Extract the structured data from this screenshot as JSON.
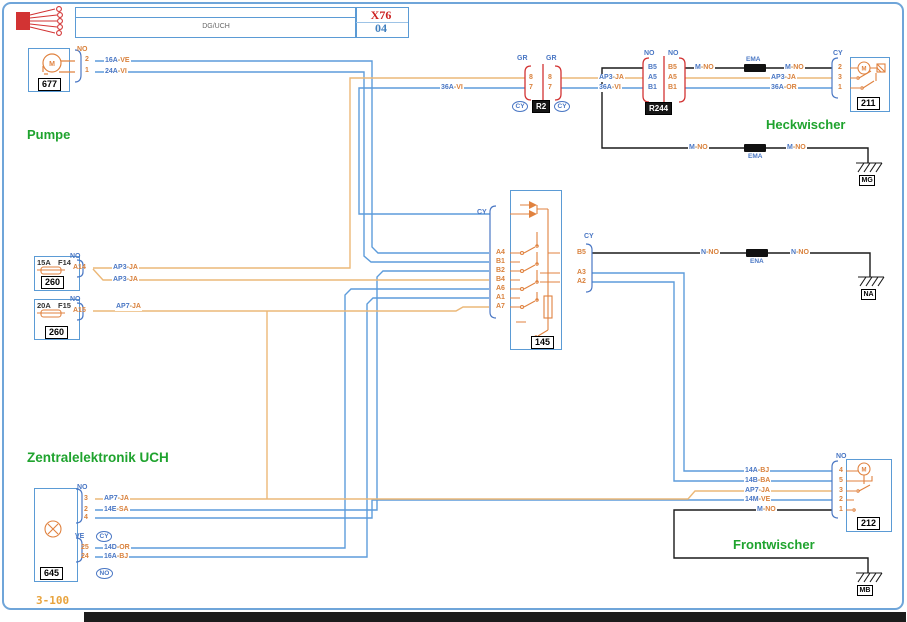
{
  "header": {
    "unit": "DG/UCH",
    "model": "X76",
    "page": "04"
  },
  "captions": {
    "pump": "Pumpe",
    "rear_wiper": "Heckwischer",
    "uch": "Zentralelektronik UCH",
    "front_wiper": "Frontwischer",
    "page_ref": "3-100"
  },
  "components": {
    "pump": {
      "number": "677",
      "connector": "NO",
      "pins": [
        "2",
        "1"
      ]
    },
    "r2": {
      "label": "R2",
      "connector_left": "GR",
      "connector_right": "GR",
      "pins": [
        "8",
        "7"
      ],
      "face": "CY"
    },
    "r244": {
      "label": "R244",
      "connector_left": "NO",
      "connector_right": "NO",
      "pins": [
        "B5",
        "A5",
        "B1"
      ]
    },
    "rear_wiper": {
      "number": "211",
      "connector": "CY",
      "pins": [
        "2",
        "3",
        "1"
      ]
    },
    "relay": {
      "number": "145",
      "connector_left": "CY",
      "connector_right": "CY",
      "pins_left": [
        "A4",
        "B1",
        "B2",
        "B4",
        "A6",
        "A1",
        "A7"
      ],
      "pins_right": [
        "B5",
        "A3",
        "A2"
      ]
    },
    "fuse_f14": {
      "rating": "15A",
      "name": "F14",
      "number": "260",
      "connector": "NO",
      "pin": "A14"
    },
    "fuse_f15": {
      "rating": "20A",
      "name": "F15",
      "number": "260",
      "connector": "NO",
      "pin": "A15"
    },
    "uch": {
      "number": "645",
      "connector_top": "NO",
      "pins_top": [
        "3",
        "2",
        "4"
      ],
      "connector_bottom": "VE",
      "pins_bottom": [
        "25",
        "24"
      ],
      "face_top": "CY",
      "face_bottom": "NO"
    },
    "front_wiper": {
      "number": "212",
      "connector": "NO",
      "pins": [
        "4",
        "5",
        "3",
        "2",
        "1"
      ]
    }
  },
  "grounds": {
    "mg": "MG",
    "na": "NA",
    "mb": "MB"
  },
  "splices": {
    "ema": "EMA",
    "ena": "ENA"
  },
  "icons": {
    "motor_letter": "M"
  },
  "wire_labels": {
    "w16ave": {
      "id": "16A",
      "color": "VE"
    },
    "w24avi": {
      "id": "24A",
      "color": "VI"
    },
    "w36avi": {
      "id": "36A",
      "color": "VI"
    },
    "w36aor": {
      "id": "36A",
      "color": "OR"
    },
    "ap3": {
      "id": "AP3",
      "color": "JA"
    },
    "ap7": {
      "id": "AP7",
      "color": "JA"
    },
    "mno": {
      "id": "M",
      "color": "NO"
    },
    "nno": {
      "id": "N",
      "color": "NO"
    },
    "w14abj": {
      "id": "14A",
      "color": "BJ"
    },
    "w14bba": {
      "id": "14B",
      "color": "BA"
    },
    "w14esa": {
      "id": "14E",
      "color": "SA"
    },
    "w14mve": {
      "id": "14M",
      "color": "VE"
    },
    "w14dor": {
      "id": "14D",
      "color": "OR"
    },
    "w16abj": {
      "id": "16A",
      "color": "BJ"
    }
  },
  "palette": {
    "wire_blue": "#5d9cdb",
    "wire_orange": "#ecb878",
    "wire_black": "#1a1a1a",
    "component_blue": "#5b9bd5",
    "connector_red": "#d23333",
    "pin_orange": "#d9813c",
    "connector_label_blue": "#4a77c4",
    "caption_green": "#1fa32e",
    "model_red": "#cc2222",
    "page_blue": "#3f7fbf",
    "internal_orange": "#e0823f",
    "page_ref_orange": "#e8a33d"
  }
}
